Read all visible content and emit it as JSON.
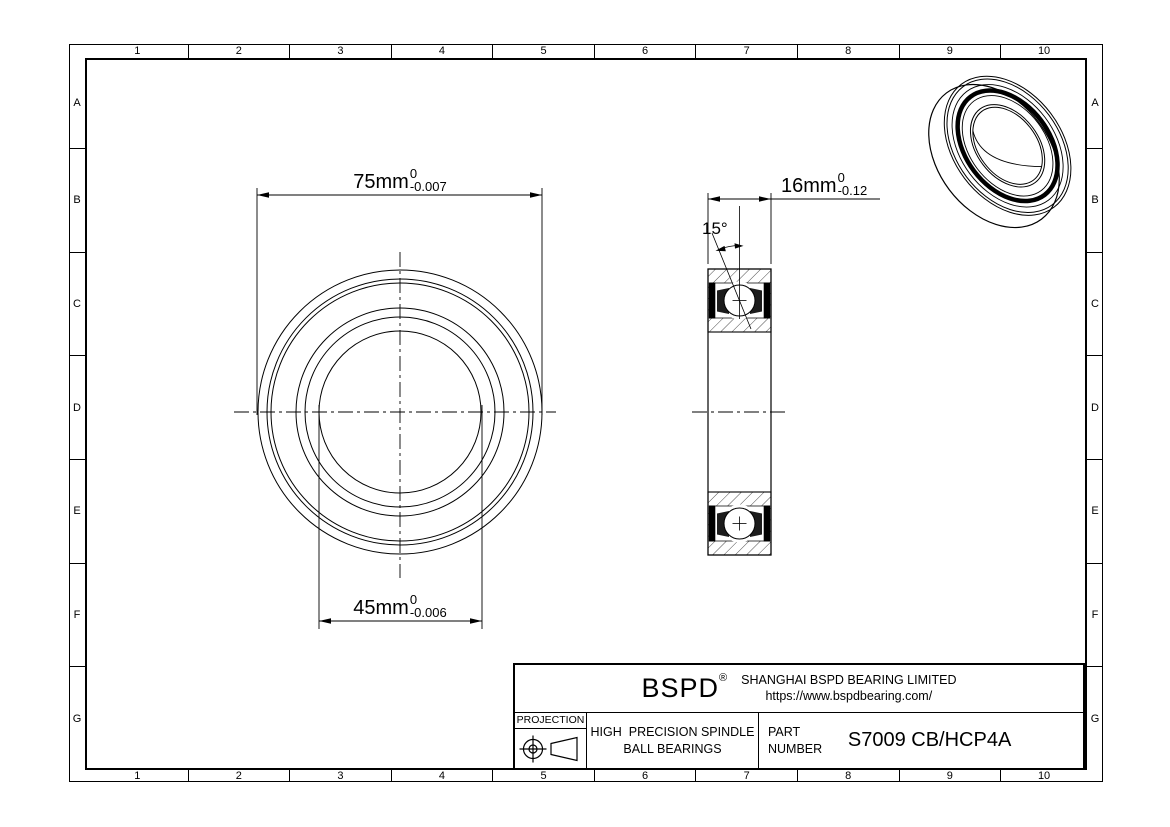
{
  "grid": {
    "cols": [
      "1",
      "2",
      "3",
      "4",
      "5",
      "6",
      "7",
      "8",
      "9",
      "10"
    ],
    "rows": [
      "A",
      "B",
      "C",
      "D",
      "E",
      "F",
      "G"
    ]
  },
  "dims": {
    "od": {
      "value": "75mm",
      "tol_upper": "0",
      "tol_lower": "-0.007"
    },
    "bore": {
      "value": "45mm",
      "tol_upper": "0",
      "tol_lower": "-0.006"
    },
    "width": {
      "value": "16mm",
      "tol_upper": "0",
      "tol_lower": "-0.12"
    },
    "contact_angle": "15°"
  },
  "title_block": {
    "logo": "BSPD",
    "logo_mark": "®",
    "company": "SHANGHAI BSPD BEARING LIMITED",
    "website": "https://www.bspdbearing.com/",
    "projection_label": "PROJECTION",
    "product_line1": "HIGH  PRECISION SPINDLE",
    "product_line2": "BALL BEARINGS",
    "part_label_line1": "PART",
    "part_label_line2": "NUMBER",
    "part_number": "S7009 CB/HCP4A"
  },
  "colors": {
    "line": "#000000",
    "background": "#ffffff"
  }
}
